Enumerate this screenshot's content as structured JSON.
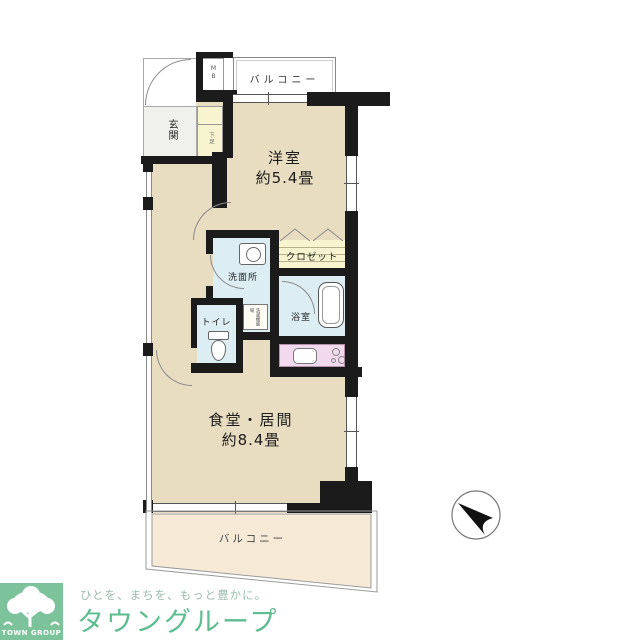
{
  "floorplan": {
    "balcony_top": {
      "label": "バルコニー"
    },
    "meter_box": {
      "label": "MB"
    },
    "entrance": {
      "label": "玄関"
    },
    "shoe_cabinet": {
      "label": "下足"
    },
    "western_room": {
      "name": "洋室",
      "area": "約5.4畳"
    },
    "closet": {
      "label": "クロゼット"
    },
    "washroom": {
      "label": "洗面所"
    },
    "laundry_space": {
      "label": "洗濯機置場"
    },
    "bathroom": {
      "label": "浴室"
    },
    "toilet": {
      "label": "トイレ"
    },
    "living_dining": {
      "name": "食堂・居間",
      "area": "約8.4畳"
    },
    "balcony_bottom": {
      "label": "バルコニー"
    }
  },
  "compass": {
    "direction": "north-west"
  },
  "branding": {
    "logo_caption": "TOWN GROUP",
    "tagline": "ひとを、まちを、もっと豊かに。",
    "company_name": "タウングループ"
  },
  "colors": {
    "floor": "#e8dcc1",
    "wall": "#1b1b1b",
    "wet_area": "#dceef3",
    "closet_fill": "#f7f4cf",
    "kitchen_counter": "#f3d9ee",
    "balcony_lower": "#f6ead6",
    "brand_green": "#7cc39c",
    "brand_text_green": "#5cbd90"
  }
}
